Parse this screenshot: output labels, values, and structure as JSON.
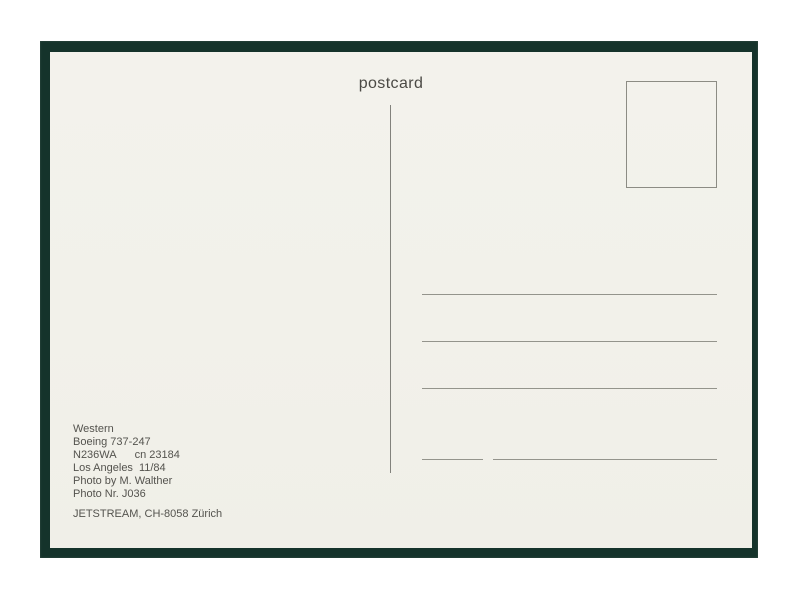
{
  "scan": {
    "title": "postcard",
    "photo_info": {
      "airline": "Western",
      "aircraft": "Boeing 737-247",
      "registration": "N236WA",
      "construction_number": "cn 23184",
      "location": "Los Angeles",
      "date": "11/84",
      "photographer": "Photo by M. Walther",
      "photo_number": "Photo Nr. J036",
      "publisher": "JETSTREAM, CH-8058 Zürich"
    },
    "colors": {
      "page_background": "#ffffff",
      "frame_green": "#15332b",
      "card_cream": "#f2f1ea",
      "ink_gray": "#54534e",
      "rule_gray": "#94948c"
    }
  }
}
